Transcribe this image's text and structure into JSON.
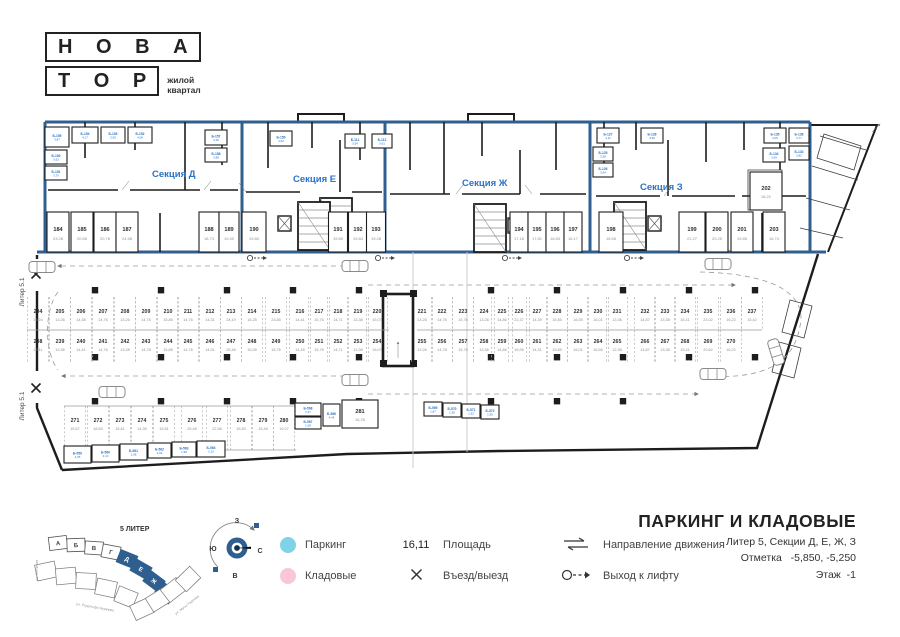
{
  "logo": {
    "top": "Н О В А",
    "bottom": "Т О Р",
    "tagline1": "жилой",
    "tagline2": "квартал"
  },
  "titleblock": {
    "title": "ПАРКИНГ И КЛАДОВЫЕ",
    "line1": "Литер 5, Секции Д, Е, Ж, З",
    "line2": "Отметка   -5,850, -5,250",
    "line3": "Этаж  -1"
  },
  "legend": {
    "parking_label": "Паркинг",
    "storage_label": "Кладовые",
    "area_value": "16,11",
    "area_label": "Площадь",
    "entry_label": "Въезд/выезд",
    "direction_label": "Направление движения",
    "lift_label": "Выход к лифту",
    "parking_color": "#7fd2e8",
    "storage_color": "#f9c6da"
  },
  "colors": {
    "blue": "#2f5f8f",
    "accent": "#2a72c5",
    "pink": "#f7c5da",
    "wall": "#1d1d1d"
  },
  "compass": {
    "west": "З",
    "south": "Ю",
    "north": "С",
    "east": "В"
  },
  "minimap": {
    "liter": "5 ЛИТЕР",
    "sections_light": [
      "А",
      "Б",
      "В",
      "Г"
    ],
    "sections_dark": [
      "Д",
      "Е",
      "Ж",
      "З"
    ],
    "streets": [
      "ул. Лётчиков",
      "ул. Рудольфа Нуреева",
      "ул. Мусы Гареева"
    ]
  },
  "plan": {
    "edge_label": "Литер 5.1",
    "sections": [
      "Секция Д",
      "Секция Е",
      "Секция Ж",
      "Секция З"
    ],
    "storages": [
      {
        "n": "184",
        "a": "23,28",
        "x": 58,
        "hw": 11
      },
      {
        "n": "185",
        "a": "20,85",
        "x": 82,
        "hw": 11
      },
      {
        "n": "186",
        "a": "20,78",
        "x": 105,
        "hw": 11
      },
      {
        "n": "187",
        "a": "24,58",
        "x": 127,
        "hw": 11
      },
      {
        "n": "188",
        "a": "18,73",
        "x": 209,
        "hw": 10
      },
      {
        "n": "189",
        "a": "19,40",
        "x": 229,
        "hw": 10
      },
      {
        "n": "190",
        "a": "19,80",
        "x": 254,
        "hw": 12
      },
      {
        "n": "191",
        "a": "19,85",
        "x": 338,
        "hw": 9.5
      },
      {
        "n": "192",
        "a": "19,84",
        "x": 358,
        "hw": 9.5
      },
      {
        "n": "193",
        "a": "19,28",
        "x": 376,
        "hw": 9.5
      },
      {
        "n": "194",
        "a": "17,16",
        "x": 519,
        "hw": 9
      },
      {
        "n": "195",
        "a": "17,81",
        "x": 537,
        "hw": 9
      },
      {
        "n": "196",
        "a": "16,83",
        "x": 555,
        "hw": 9
      },
      {
        "n": "197",
        "a": "16,17",
        "x": 573,
        "hw": 9
      },
      {
        "n": "198",
        "a": "16,55",
        "x": 611,
        "hw": 12
      },
      {
        "n": "199",
        "a": "21,27",
        "x": 692,
        "hw": 13
      },
      {
        "n": "200",
        "a": "20,25",
        "x": 717,
        "hw": 11
      },
      {
        "n": "201",
        "a": "19,85",
        "x": 742,
        "hw": 11
      },
      {
        "n": "203",
        "a": "16,74",
        "x": 774,
        "hw": 11
      }
    ],
    "storage202": {
      "n": "202",
      "a": "16,21"
    },
    "room281": {
      "n": "281",
      "a": "16,25"
    },
    "row1": [
      {
        "n": "204",
        "a": "15,24",
        "x": 38
      },
      {
        "n": "205",
        "a": "13,26",
        "x": 60
      },
      {
        "n": "206",
        "a": "14,36",
        "x": 81
      },
      {
        "n": "207",
        "a": "14,76",
        "x": 103
      },
      {
        "n": "208",
        "a": "13,26",
        "x": 125
      },
      {
        "n": "209",
        "a": "14,76",
        "x": 146
      },
      {
        "n": "210",
        "a": "15,85",
        "x": 168
      },
      {
        "n": "211",
        "a": "14,76",
        "x": 188
      },
      {
        "n": "212",
        "a": "14,31",
        "x": 210
      },
      {
        "n": "213",
        "a": "24,19",
        "x": 231
      },
      {
        "n": "214",
        "a": "15,25",
        "x": 252
      },
      {
        "n": "215",
        "a": "23,85",
        "x": 276
      },
      {
        "n": "216",
        "a": "14,41",
        "x": 300
      },
      {
        "n": "217",
        "a": "15,76",
        "x": 319
      },
      {
        "n": "218",
        "a": "14,71",
        "x": 338
      },
      {
        "n": "219",
        "a": "13,38",
        "x": 358
      },
      {
        "n": "220",
        "a": "15,07",
        "x": 377
      },
      {
        "n": "221",
        "a": "13,26",
        "x": 422
      },
      {
        "n": "222",
        "a": "14,76",
        "x": 442
      },
      {
        "n": "223",
        "a": "15,76",
        "x": 463
      },
      {
        "n": "224",
        "a": "13,26",
        "x": 484
      },
      {
        "n": "225",
        "a": "14,86",
        "x": 502
      },
      {
        "n": "226",
        "a": "22,37",
        "x": 519
      },
      {
        "n": "227",
        "a": "14,39",
        "x": 537
      },
      {
        "n": "228",
        "a": "15,85",
        "x": 557
      },
      {
        "n": "229",
        "a": "16,55",
        "x": 578
      },
      {
        "n": "230",
        "a": "16,01",
        "x": 598
      },
      {
        "n": "231",
        "a": "13,36",
        "x": 617
      },
      {
        "n": "232",
        "a": "14,87",
        "x": 645
      },
      {
        "n": "233",
        "a": "13,38",
        "x": 665
      },
      {
        "n": "234",
        "a": "15,41",
        "x": 685
      },
      {
        "n": "235",
        "a": "23,02",
        "x": 708
      },
      {
        "n": "236",
        "a": "16,22",
        "x": 731
      },
      {
        "n": "237",
        "a": "15,42",
        "x": 752
      }
    ],
    "row2": [
      {
        "n": "238",
        "a": "13,11",
        "x": 38
      },
      {
        "n": "239",
        "a": "13,36",
        "x": 60
      },
      {
        "n": "240",
        "a": "14,41",
        "x": 81
      },
      {
        "n": "241",
        "a": "14,76",
        "x": 103
      },
      {
        "n": "242",
        "a": "13,38",
        "x": 125
      },
      {
        "n": "243",
        "a": "14,76",
        "x": 146
      },
      {
        "n": "244",
        "a": "15,85",
        "x": 168
      },
      {
        "n": "245",
        "a": "14,76",
        "x": 188
      },
      {
        "n": "246",
        "a": "14,51",
        "x": 210
      },
      {
        "n": "247",
        "a": "25,46",
        "x": 231
      },
      {
        "n": "248",
        "a": "15,05",
        "x": 252
      },
      {
        "n": "249",
        "a": "15,76",
        "x": 276
      },
      {
        "n": "250",
        "a": "14,45",
        "x": 300
      },
      {
        "n": "251",
        "a": "15,76",
        "x": 319
      },
      {
        "n": "252",
        "a": "14,71",
        "x": 338
      },
      {
        "n": "253",
        "a": "13,38",
        "x": 358
      },
      {
        "n": "254",
        "a": "15,07",
        "x": 377
      },
      {
        "n": "255",
        "a": "13,26",
        "x": 422
      },
      {
        "n": "256",
        "a": "14,76",
        "x": 442
      },
      {
        "n": "257",
        "a": "15,76",
        "x": 463
      },
      {
        "n": "258",
        "a": "13,38",
        "x": 484
      },
      {
        "n": "259",
        "a": "14,86",
        "x": 502
      },
      {
        "n": "260",
        "a": "16,95",
        "x": 519
      },
      {
        "n": "261",
        "a": "14,31",
        "x": 537
      },
      {
        "n": "262",
        "a": "15,85",
        "x": 557
      },
      {
        "n": "263",
        "a": "16,01",
        "x": 578
      },
      {
        "n": "264",
        "a": "16,55",
        "x": 598
      },
      {
        "n": "265",
        "a": "12,38",
        "x": 617
      },
      {
        "n": "266",
        "a": "14,87",
        "x": 645
      },
      {
        "n": "267",
        "a": "13,38",
        "x": 665
      },
      {
        "n": "268",
        "a": "15,41",
        "x": 685
      },
      {
        "n": "269",
        "a": "20,62",
        "x": 708
      },
      {
        "n": "270",
        "a": "16,22",
        "x": 731
      }
    ],
    "row3": [
      {
        "n": "271",
        "a": "15,67",
        "x": 75
      },
      {
        "n": "272",
        "a": "18,83",
        "x": 98
      },
      {
        "n": "273",
        "a": "15,81",
        "x": 120
      },
      {
        "n": "274",
        "a": "14,35",
        "x": 142
      },
      {
        "n": "275",
        "a": "15,81",
        "x": 164
      },
      {
        "n": "276",
        "a": "25,48",
        "x": 192
      },
      {
        "n": "277",
        "a": "22,58",
        "x": 217
      },
      {
        "n": "278",
        "a": "15,83",
        "x": 241
      },
      {
        "n": "279",
        "a": "15,48",
        "x": 263
      },
      {
        "n": "280",
        "a": "19,07",
        "x": 284
      }
    ],
    "cellars": [
      {
        "t": "Б-155",
        "a": "3,87",
        "x": 45,
        "y": 127,
        "w": 24,
        "h": 20,
        "pink": true
      },
      {
        "t": "Б-154",
        "a": "4,17",
        "x": 72,
        "y": 127,
        "w": 26,
        "h": 16
      },
      {
        "t": "Б-153",
        "a": "3,95",
        "x": 101,
        "y": 127,
        "w": 24,
        "h": 16
      },
      {
        "t": "Б-152",
        "a": "4,08",
        "x": 128,
        "y": 127,
        "w": 24,
        "h": 16
      },
      {
        "t": "Б-150",
        "a": "3,62",
        "x": 45,
        "y": 150,
        "w": 22,
        "h": 14
      },
      {
        "t": "Б-151",
        "a": "3,70",
        "x": 45,
        "y": 166,
        "w": 22,
        "h": 14
      },
      {
        "t": "Б-157",
        "a": "4,25",
        "x": 205,
        "y": 130,
        "w": 22,
        "h": 15
      },
      {
        "t": "Б-158",
        "a": "3,88",
        "x": 205,
        "y": 148,
        "w": 22,
        "h": 14
      },
      {
        "t": "Б-159",
        "a": "4,02",
        "x": 270,
        "y": 131,
        "w": 22,
        "h": 15
      },
      {
        "t": "Б-111",
        "a": "3,54",
        "x": 345,
        "y": 134,
        "w": 20,
        "h": 14
      },
      {
        "t": "Б-112",
        "a": "3,61",
        "x": 372,
        "y": 134,
        "w": 20,
        "h": 14
      },
      {
        "t": "Б-127",
        "a": "4,11",
        "x": 597,
        "y": 128,
        "w": 22,
        "h": 15
      },
      {
        "t": "Б-128",
        "a": "3,96",
        "x": 641,
        "y": 128,
        "w": 22,
        "h": 15
      },
      {
        "t": "Б-125",
        "a": "3,58",
        "x": 593,
        "y": 147,
        "w": 20,
        "h": 14
      },
      {
        "t": "Б-126",
        "a": "3,64",
        "x": 593,
        "y": 163,
        "w": 20,
        "h": 14
      },
      {
        "t": "Б-135",
        "a": "4,05",
        "x": 764,
        "y": 128,
        "w": 22,
        "h": 15
      },
      {
        "t": "Б-136",
        "a": "3,77",
        "x": 789,
        "y": 128,
        "w": 20,
        "h": 15
      },
      {
        "t": "Б-133",
        "a": "3,82",
        "x": 789,
        "y": 146,
        "w": 20,
        "h": 14
      },
      {
        "t": "Б-134",
        "a": "3,69",
        "x": 763,
        "y": 148,
        "w": 22,
        "h": 14
      },
      {
        "t": "Б-568",
        "a": "1,97",
        "x": 295,
        "y": 403,
        "w": 26,
        "h": 13
      },
      {
        "t": "Б-566",
        "a": "4,46",
        "x": 323,
        "y": 404,
        "w": 17,
        "h": 22
      },
      {
        "t": "Б-567",
        "a": "1,68",
        "x": 295,
        "y": 417,
        "w": 26,
        "h": 12
      },
      {
        "t": "Б-569",
        "a": "1,87",
        "x": 424,
        "y": 402,
        "w": 18,
        "h": 14
      },
      {
        "t": "Б-570",
        "a": "1,90",
        "x": 443,
        "y": 403,
        "w": 18,
        "h": 14
      },
      {
        "t": "Б-571",
        "a": "1,92",
        "x": 462,
        "y": 404,
        "w": 18,
        "h": 14
      },
      {
        "t": "Б-572",
        "a": "1,95",
        "x": 481,
        "y": 405,
        "w": 18,
        "h": 14
      },
      {
        "t": "Б-559",
        "a": "2,05",
        "x": 64,
        "y": 446,
        "w": 27,
        "h": 17
      },
      {
        "t": "Б-560",
        "a": "2,10",
        "x": 92,
        "y": 445,
        "w": 27,
        "h": 17
      },
      {
        "t": "Б-561",
        "a": "2,08",
        "x": 120,
        "y": 444,
        "w": 27,
        "h": 16
      },
      {
        "t": "Б-562",
        "a": "2,02",
        "x": 148,
        "y": 443,
        "w": 23,
        "h": 15
      },
      {
        "t": "Б-563",
        "a": "1,98",
        "x": 172,
        "y": 442,
        "w": 24,
        "h": 15
      },
      {
        "t": "Б-564",
        "a": "2,15",
        "x": 197,
        "y": 441,
        "w": 28,
        "h": 16
      }
    ]
  }
}
